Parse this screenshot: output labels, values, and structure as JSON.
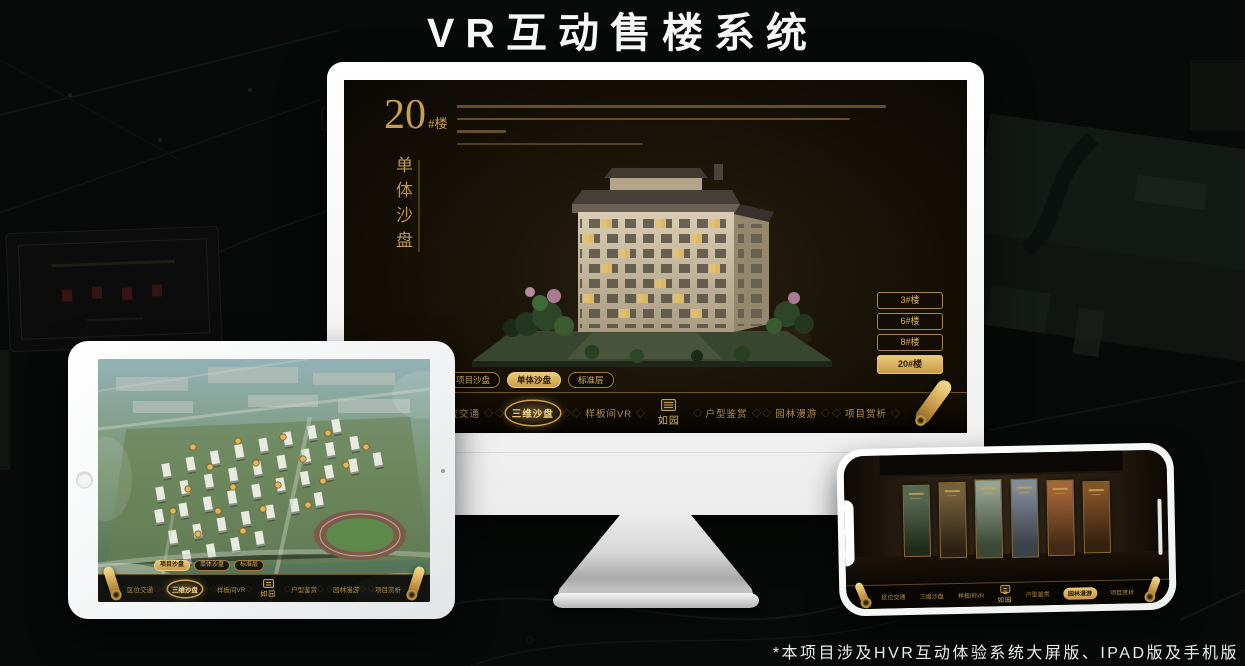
{
  "page": {
    "title": "VR互动售楼系统",
    "footnote": "*本项目涉及HVR互动体验系统大屏版、IPAD版及手机版"
  },
  "brand": {
    "logo": "如园",
    "gold": "#c8a050",
    "gold_bright": "#ecc878",
    "screen_bg": "#171107"
  },
  "monitor": {
    "screen": {
      "block_number": "20",
      "block_suffix": "#楼",
      "vertical_title": "单体沙盘",
      "floor_buttons": [
        {
          "label": "3#楼",
          "active": false
        },
        {
          "label": "6#楼",
          "active": false
        },
        {
          "label": "8#楼",
          "active": false
        },
        {
          "label": "20#楼",
          "active": true
        }
      ],
      "sub_tabs": [
        {
          "label": "项目沙盘",
          "active": false
        },
        {
          "label": "单体沙盘",
          "active": true
        },
        {
          "label": "标准层",
          "active": false
        }
      ],
      "nav": {
        "items_left": [
          "区位交通",
          "三维沙盘",
          "样板间VR"
        ],
        "items_right": [
          "户型鉴赏",
          "园林漫游",
          "项目赏析"
        ],
        "active_item": "三维沙盘",
        "logo": "如园"
      }
    }
  },
  "tablet": {
    "sub_tabs": [
      {
        "label": "项目沙盘",
        "active": true
      },
      {
        "label": "单体沙盘",
        "active": false
      },
      {
        "label": "标准层",
        "active": false
      }
    ],
    "nav": {
      "items_left": [
        "区位交通",
        "三维沙盘",
        "样板间VR"
      ],
      "items_right": [
        "户型鉴赏",
        "园林漫游",
        "项目赏析"
      ],
      "active_item": "三维沙盘",
      "logo": "如园"
    }
  },
  "phone": {
    "nav": {
      "items_left": [
        "区位交通",
        "三维沙盘",
        "样板间VR"
      ],
      "items_right": [
        "户型鉴赏",
        "园林漫游",
        "项目赏析"
      ],
      "active_item": "园林漫游",
      "logo": "如园"
    }
  }
}
